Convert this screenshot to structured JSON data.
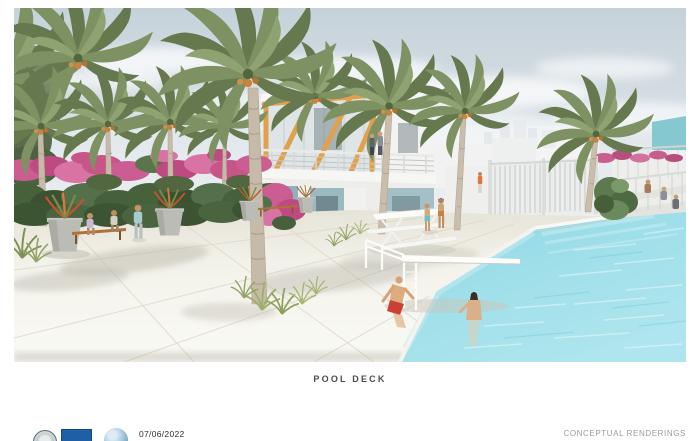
{
  "slide": {
    "caption": "POOL DECK",
    "footer": {
      "date": "07/06/2022",
      "rendering_label": "CONCEPTUAL RENDERINGS"
    },
    "logos": [
      "city-seal",
      "flag",
      "globe"
    ],
    "scene": "Architectural rendering of a residential pool deck with palm trees, bougainvillea hedge, two-story clubhouse with orange frame and teal cabanas, diving board and swimming pool"
  },
  "colors": {
    "sky": "#c7d3db",
    "pool_water": "#97dbe7",
    "deck": "#f2f0e8",
    "palm_foliage": "#7d8f63",
    "bougainvillea": "#c75d92",
    "building_orange": "#e2a04b",
    "building_teal": "#9bb9c1",
    "caption_text": "#4b4c4e",
    "footer_text": "#9b9b9b",
    "flag_logo_blue": "#1f5fa5"
  }
}
